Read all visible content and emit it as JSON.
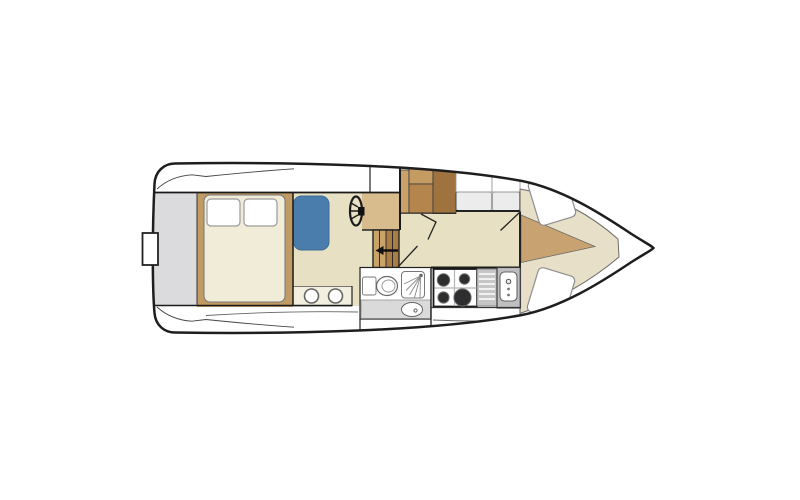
{
  "diagram": {
    "type": "boat-floor-plan",
    "orientation": "bow-right",
    "areas": [
      "swim-platform",
      "aft-cabin",
      "salon",
      "helm-station",
      "companionway",
      "wet-head",
      "galley",
      "dinette-seating",
      "bow-cabin",
      "foredeck"
    ],
    "fixtures": [
      "transom-gate",
      "double-berth",
      "pillow-left",
      "pillow-right",
      "side-berth-blue",
      "vanity-counter-two-sinks",
      "steering-wheel",
      "helm-console",
      "companionway-steps",
      "descent-arrow",
      "wardrobe",
      "storage-cabinets",
      "door-swings",
      "toilet",
      "shower",
      "washbasin",
      "stove-four-burners",
      "drainboard",
      "galley-sink",
      "v-berth-upper",
      "v-berth-lower",
      "bow-walkway-wedge"
    ]
  },
  "palette": {
    "white": "#ffffff",
    "hull_line": "#1e1e1e",
    "stern_gray": "#dbdbdd",
    "wood": "#c29a63",
    "mattress_cream": "#f1ecd8",
    "berth_blue": "#4a7cac",
    "floor_beige": "#e8e0c3",
    "bow_beige": "#e7dfc7",
    "wedge_tan": "#c9a271",
    "console_tan": "#d9bc8e",
    "cabinet_light": "#c9a169",
    "cabinet_mid_top": "#c49c63",
    "cabinet_mid": "#b5854e",
    "cabinet_dark": "#9f733d",
    "step_light": "#c9a469",
    "step_dark": "#ab7d46",
    "cushion_gray": "#ececec",
    "counter_cream": "#f3efde",
    "drain_gray": "#c6c6c6",
    "sink_gray": "#bfbfc1",
    "vanity_gray": "#dadadb",
    "burner_dark": "#2e2e30"
  }
}
